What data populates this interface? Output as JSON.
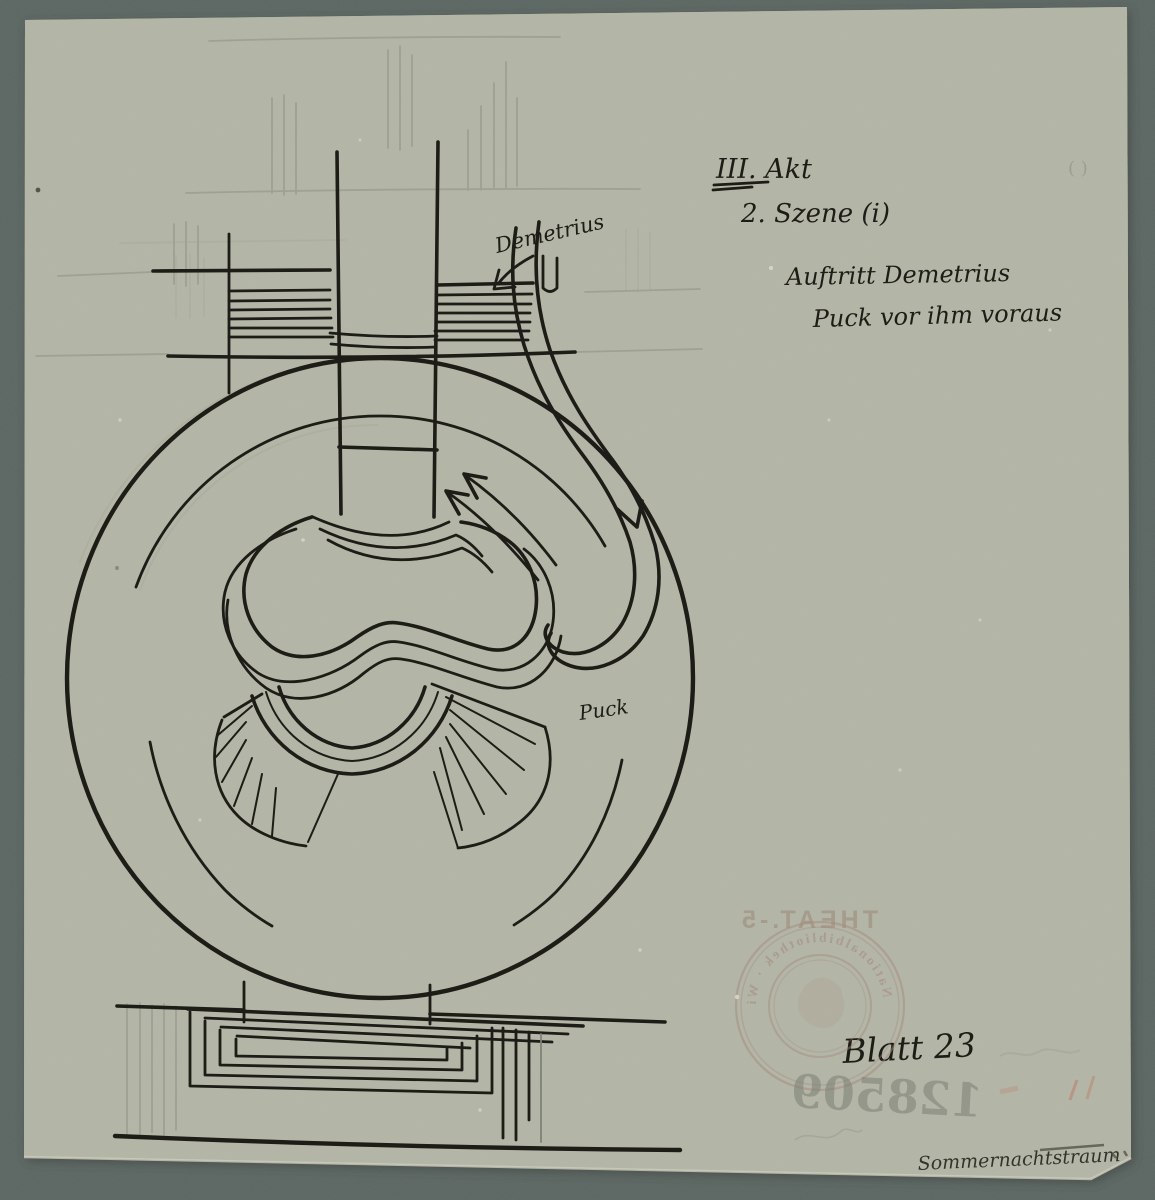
{
  "scene_note": {
    "act": "III. Akt",
    "scene": "2. Szene (i)",
    "entrance_line1": "Auftritt Demetrius",
    "entrance_line2": "Puck vor ihm voraus"
  },
  "plan_labels": {
    "demetrius": "Demetrius",
    "puck": "Puck"
  },
  "sheet_label": "Blatt 23",
  "bottom_title": "Sommernachtstraum",
  "pencil_mark": "( )",
  "verso_bleedthrough": {
    "collection_mark": "THEAT.-5",
    "inventory_number": "128509",
    "stamp_ring_text": "Nationalbibliothek · Wien ·"
  },
  "colors": {
    "mat_background": "#5c6662",
    "paper": "#b3b5a6",
    "ink": "#1d1c16",
    "pencil": "#7f8278",
    "stamp_red_brown": "#a5887a",
    "red_mark": "#c25844"
  }
}
